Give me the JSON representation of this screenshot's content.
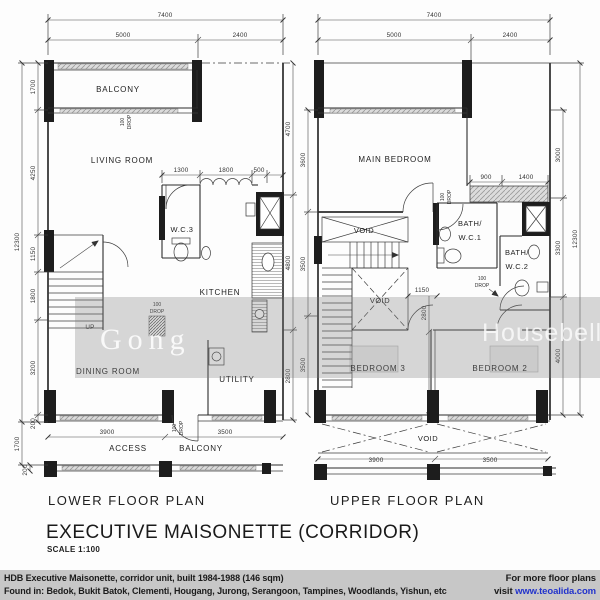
{
  "watermark": {
    "left": "Gong",
    "right": "Housebell"
  },
  "titles": {
    "lower_plan": "LOWER FLOOR PLAN",
    "upper_plan": "UPPER FLOOR PLAN",
    "main": "EXECUTIVE MAISONETTE (CORRIDOR)",
    "scale": "SCALE 1:100"
  },
  "drop": {
    "l1": "100",
    "l2": "DROP"
  },
  "stairs": {
    "up": "UP"
  },
  "lower": {
    "rooms": {
      "balcony": "BALCONY",
      "living": "LIVING ROOM",
      "wc3": "W.C.3",
      "kitchen": "KITCHEN",
      "dining": "DINING ROOM",
      "utility": "UTILITY",
      "access": "ACCESS",
      "balcony2": "BALCONY"
    },
    "dims": {
      "total_w": "7400",
      "w1": "5000",
      "w2": "2400",
      "d1": "1300",
      "d2": "1800",
      "d3": "500",
      "left_total": "12300",
      "l1": "1700",
      "l2": "4250",
      "l3": "1150",
      "l4": "1800",
      "l5": "3200",
      "l6": "200",
      "l7": "1700",
      "l8": "200",
      "r1": "4700",
      "r2": "4800",
      "r3": "2800",
      "b1": "3900",
      "b2": "3500"
    }
  },
  "upper": {
    "rooms": {
      "main_bedroom": "MAIN BEDROOM",
      "bath1a": "BATH/",
      "bath1b": "W.C.1",
      "bath2a": "BATH/",
      "bath2b": "W.C.2",
      "void": "VOID",
      "bed3": "BEDROOM 3",
      "bed2": "BEDROOM 2"
    },
    "dims": {
      "total_w": "7400",
      "w1": "5000",
      "w2": "2400",
      "ward1": "900",
      "ward2": "1400",
      "hall": "1150",
      "bed_d": "2800",
      "left1": "3600",
      "left2": "3500",
      "left3": "3500",
      "r1": "3000",
      "r2": "3300",
      "r3": "4000",
      "right_total": "12300",
      "b1": "3900",
      "b2": "3500"
    }
  },
  "footer": {
    "line1": "HDB Executive Maisonette, corridor unit, built 1984-1988 (146 sqm)",
    "line2": "Found in: Bedok, Bukit Batok, Clementi, Hougang, Jurong, Serangoon, Tampines, Woodlands, Yishun, etc",
    "promo1": "For more floor plans",
    "promo2": "visit ",
    "link": "www.teoalida.com"
  }
}
